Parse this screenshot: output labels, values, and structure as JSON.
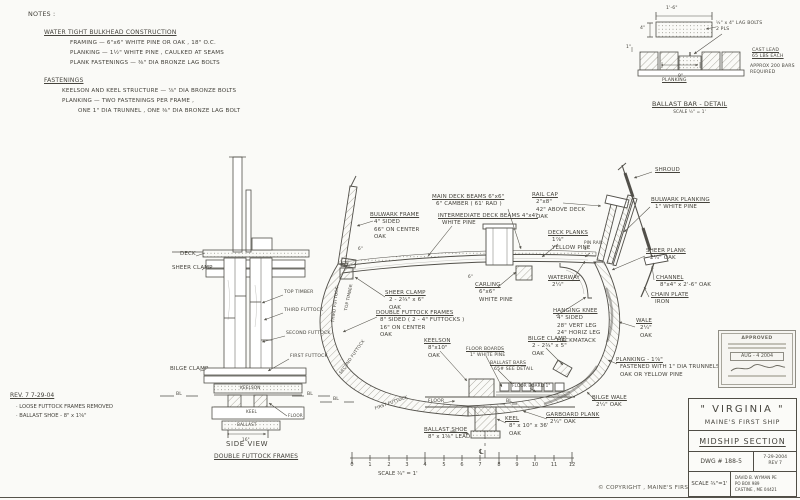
{
  "sheet": {
    "paper": "#fafaf7",
    "ink": "#4a4841"
  },
  "notes": {
    "title": "NOTES :",
    "sections": [
      {
        "heading": "WATER TIGHT BULKHEAD CONSTRUCTION",
        "lines": [
          "FRAMING  —  6\"x6\"  WHITE PINE OR OAK , 18\" O.C.",
          "PLANKING  —  1½\"  WHITE PINE , CAULKED AT SEAMS",
          "PLANK FASTENINGS  —  ⅜\" DIA BRONZE LAG BOLTS"
        ]
      },
      {
        "heading": "FASTENINGS",
        "lines": [
          "KEELSON AND KEEL STRUCTURE  —  ⅞\" DIA BRONZE BOLTS",
          "PLANKING  —  TWO FASTENINGS PER FRAME ,",
          "ONE 1\" DIA TRUNNEL ,  ONE ⅜\" DIA BRONZE LAG BOLT"
        ]
      }
    ]
  },
  "ballast_detail": {
    "dim_length": "1'-6\"",
    "dim_height": "4\"",
    "dim_one": "1\"",
    "dim_nine": "9\"",
    "lag_note": "½\" x 4\" LAG BOLTS\n2 PLS",
    "lead_note": "CAST LEAD\n65 LBS EACH",
    "qty_note": "APPROX 200 BARS\nREQUIRED",
    "planking": "PLANKING",
    "title": "BALLAST BAR - DETAIL",
    "scale": "SCALE  ½\" = 1'"
  },
  "side_view": {
    "deck": "DECK",
    "sheer_clamp": "SHEER CLAMP",
    "top_timber": "TOP TIMBER",
    "third_futtock": "THIRD FUTTOCK",
    "second_futtock": "SECOND FUTTOCK",
    "first_futtock": "FIRST FUTTOCK",
    "bilge_clamp": "BILGE CLAMP",
    "keelson": "KEELSON",
    "keel": "KEEL",
    "ballast": "BALLAST",
    "floor": "FLOOR",
    "dim16": "16\"",
    "bl": "BL",
    "title": "SIDE VIEW",
    "subtitle": "DOUBLE FUTTOCK FRAMES"
  },
  "rev_note": {
    "heading": "REV. 7      7-29-04",
    "items": [
      "·  LOOSE FUTTOCK FRAMES REMOVED",
      "·  BALLAST SHOE - 8\" x 1⅝\""
    ]
  },
  "main": {
    "labels": {
      "bulwark_frame": {
        "h": "BULWARK FRAME",
        "r": "4\" SIDED\n66\" ON CENTER\nOAK"
      },
      "main_deck_beams": {
        "h": "MAIN DECK BEAMS  6\"x6\"",
        "r": "6\" CAMBER ( 61' RAD )"
      },
      "int_deck_beams": {
        "h": "INTERMEDIATE DECK BEAMS  4\"x4\"",
        "r": "WHITE PINE"
      },
      "rail_cap": {
        "h": "RAIL CAP",
        "r": "2\"x8\"\n42\" ABOVE DECK\nOAK"
      },
      "shroud": {
        "h": "SHROUD"
      },
      "bulwark_planking": {
        "h": "BULWARK PLANKING",
        "r": "1\" WHITE PINE"
      },
      "deck_planks": {
        "h": "DECK PLANKS",
        "r": "1⅞\"\nYELLOW PINE"
      },
      "pin_rail": {
        "h": "PIN RAIL",
        "r": "4\""
      },
      "sheer_plank": {
        "h": "SHEER PLANK",
        "r": "2¼\"  OAK"
      },
      "channel": {
        "h": "CHANNEL",
        "r": "8\"x4\" x 2'-6\"  OAK"
      },
      "chain_plate": {
        "h": "CHAIN PLATE",
        "r": "IRON"
      },
      "wale": {
        "h": "WALE",
        "r": "2¼\"\nOAK"
      },
      "carling": {
        "h": "CARLING",
        "r": "6\"x6\"\nWHITE PINE"
      },
      "waterway": {
        "h": "WATERWAY",
        "r": "2¼\""
      },
      "hanging_knee": {
        "h": "HANGING KNEE",
        "r": "4\" SIDED\n28\" VERT LEG\n24\" HORIZ LEG\nHACKMATACK"
      },
      "sheer_clamp": {
        "h": "SHEER CLAMP",
        "r": "2 - 2¾\" x 6\"\nOAK"
      },
      "dbl_futtock": {
        "h": "DOUBLE FUTTOCK FRAMES",
        "r": "8\" SIDED ( 2 - 4\" FUTTOCKS )\n16\" ON CENTER\nOAK"
      },
      "keelson": {
        "h": "KEELSON",
        "r": "8\"x10\"\nOAK"
      },
      "floor_boards": {
        "h": "FLOOR BOARDS",
        "r": "1\" WHITE PINE"
      },
      "ballast_bars": {
        "h": "BALLAST BARS",
        "r": "65#  SEE DETAIL"
      },
      "bilge_clamp": {
        "h": "BILGE CLAMP",
        "r": "2 - 2¾\" x 5\"\nOAK"
      },
      "ballast_shoe": {
        "h": "BALLAST SHOE",
        "r": "8\" x 1⅝\"  LEAD"
      },
      "keel": {
        "h": "KEEL",
        "r": "8\" x 10\" x 36'\nOAK"
      },
      "garboard": {
        "h": "GARBOARD PLANK",
        "r": "2¼\"  OAK"
      },
      "bilge_wale": {
        "h": "BILGE WALE",
        "r": "2¼\"  OAK"
      },
      "planking": {
        "h": "PLANKING  -  1⅞\"",
        "r": "FASTENED WITH 1\" DIA TRUNNELS\nOAK OR YELLOW PINE"
      },
      "floor": {
        "h": "FLOOR"
      },
      "floor_board_sm": {
        "h": "FLOOR BOARD 1\""
      }
    },
    "futtocks": {
      "top_timber": "TOP TIMBER",
      "third": "THIRD FUTTOCK",
      "second": "SECOND FUTTOCK",
      "first": "FIRST FUTTOCK"
    },
    "dims": {
      "a": "6\"",
      "b": "6\""
    },
    "bl": "BL",
    "cl": "℄"
  },
  "ruler": {
    "ticks": [
      "0",
      "1",
      "2",
      "3",
      "4",
      "5",
      "6",
      "7",
      "8",
      "9",
      "10",
      "11",
      "12"
    ],
    "scale": "SCALE  ¾\" = 1'"
  },
  "copyright": "©  COPYRIGHT ,  MAINE'S FIRST SHIP",
  "stamp": {
    "approved": "APPROVED",
    "date": "AUG - 4 2004"
  },
  "title_block": {
    "ship": "\" VIRGINIA \"",
    "org": "MAINE'S  FIRST  SHIP",
    "drawing": "MIDSHIP  SECTION",
    "dwg": "DWG # 188-5",
    "date": "7-29-2004",
    "rev": "REV 7",
    "scale": "SCALE  ¾\"=1'",
    "author": "DAVID B. WYMAN  PE\nPO BOX 989\nCASTINE , ME  04421"
  }
}
